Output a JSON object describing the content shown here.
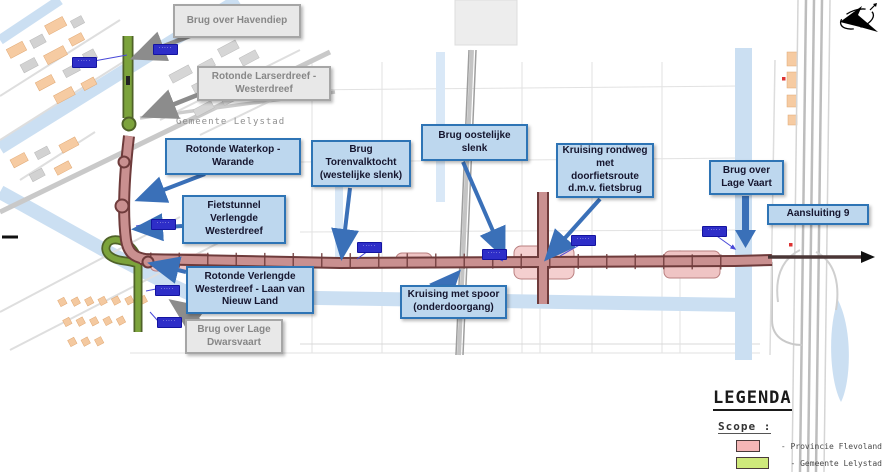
{
  "map": {
    "municipality_label": "Gemeente Lelystad",
    "object_code_badge_text": "·····"
  },
  "callouts": {
    "brug_havendiep": {
      "text": "Brug over Havendiep",
      "style": "gray"
    },
    "rotonde_larserdreef": {
      "text": "Rotonde Larserdreef - Westerdreef",
      "style": "gray"
    },
    "brug_lage_dwarsvaart": {
      "text": "Brug over Lage Dwarsvaart",
      "style": "gray"
    },
    "rotonde_waterkop": {
      "text": "Rotonde Waterkop - Warande",
      "style": "blue"
    },
    "fietstunnel": {
      "text": "Fietstunnel Verlengde Westerdreef",
      "style": "blue"
    },
    "brug_torenvalktocht": {
      "text": "Brug Torenvalktocht (westelijke slenk)",
      "style": "blue"
    },
    "brug_oostelijke_slenk": {
      "text": "Brug oostelijke slenk",
      "style": "blue"
    },
    "kruising_rondweg": {
      "text": "Kruising rondweg met doorfietsroute d.m.v. fietsbrug",
      "style": "blue"
    },
    "brug_lage_vaart": {
      "text": "Brug over Lage Vaart",
      "style": "blue"
    },
    "aansluiting_9": {
      "text": "Aansluiting 9",
      "style": "blue"
    },
    "rotonde_verlengde": {
      "text": "Rotonde Verlengde Westerdreef - Laan van Nieuw Land",
      "style": "blue"
    },
    "kruising_spoor": {
      "text": "Kruising met spoor (onderdoorgang)",
      "style": "blue"
    }
  },
  "legend": {
    "title": "LEGENDA",
    "scope_label": "Scope :",
    "items": [
      {
        "label": "- Provincie Flevoland",
        "color": "#F4B6B6"
      },
      {
        "label": "- Gemeente Lelystad",
        "color": "#CFE97B"
      }
    ]
  },
  "colors": {
    "callout_blue_fill": "#BDD7EE",
    "callout_blue_border": "#2E74B5",
    "callout_gray_fill": "#E8E8E8",
    "callout_gray_border": "#A6A6A6",
    "scope_province_road": "#C99090",
    "scope_municipality_road": "#7CA33C",
    "water": "#CBDFF2",
    "arrow_blue": "#3A70B8",
    "arrow_gray": "#8C8C8C",
    "badge_blue": "#2E2EC8"
  }
}
